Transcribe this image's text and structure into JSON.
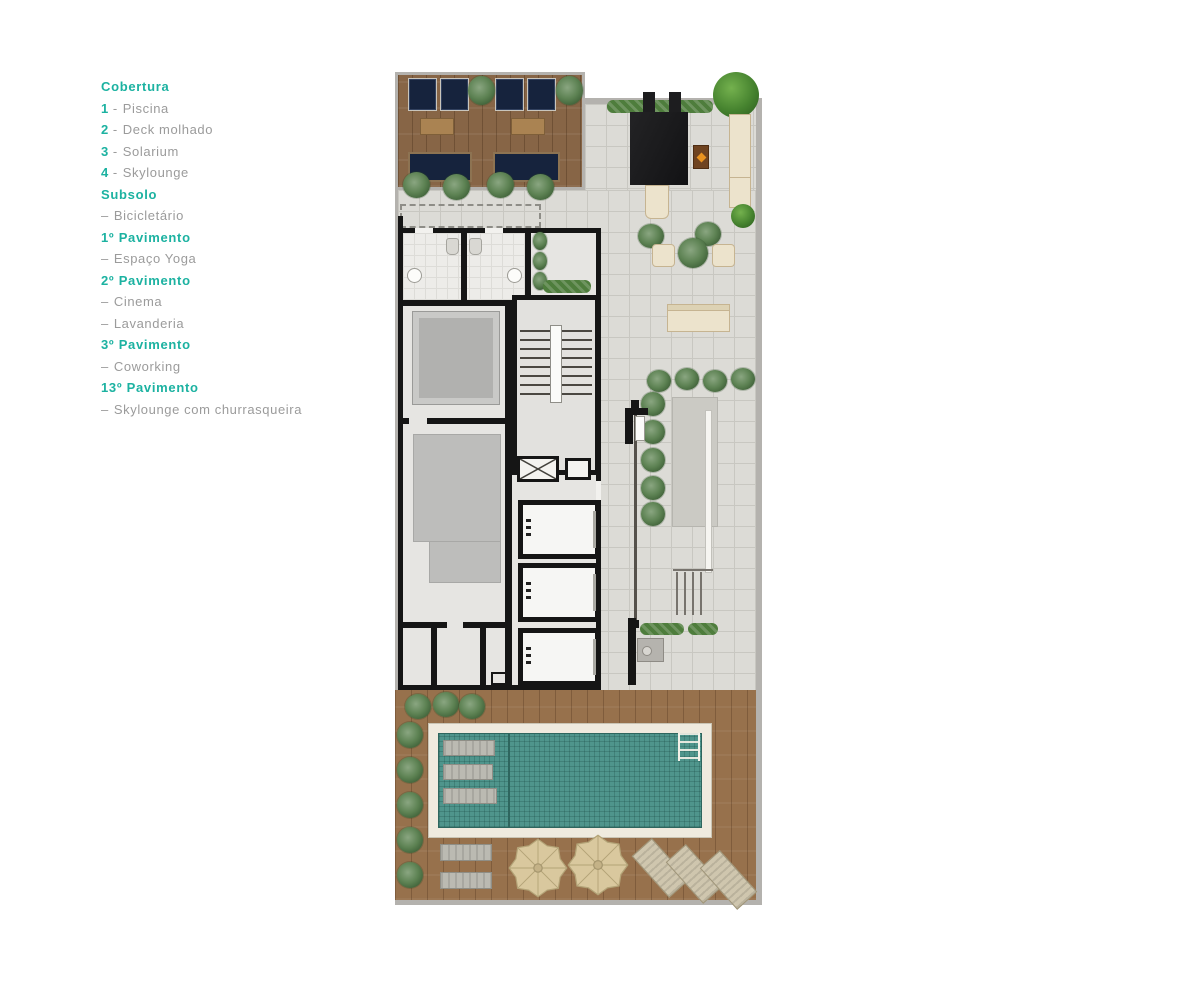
{
  "palette": {
    "accent_teal": "#1cb2a1",
    "legend_text_gray": "#9b9b9b",
    "wall_black": "#151515",
    "frame_gray": "#b4b2ae",
    "tile_gray": "#dcdbd6",
    "wood_brown": "#97714c",
    "navy_furniture": "#16233d",
    "cream_furniture": "#ece3cc",
    "pool_water_teal": "#4f958c",
    "plant_green": "#5d8253"
  },
  "legend": {
    "entries": [
      {
        "kind": "header",
        "prefix": "",
        "sep": "",
        "label": "Cobertura"
      },
      {
        "kind": "item",
        "prefix": "1",
        "sep": "-",
        "label": "Piscina"
      },
      {
        "kind": "item",
        "prefix": "2",
        "sep": "-",
        "label": "Deck molhado"
      },
      {
        "kind": "item",
        "prefix": "3",
        "sep": "-",
        "label": "Solarium"
      },
      {
        "kind": "item",
        "prefix": "4",
        "sep": "-",
        "label": "Skylounge"
      },
      {
        "kind": "header",
        "prefix": "",
        "sep": "",
        "label": "Subsolo"
      },
      {
        "kind": "item",
        "prefix": "",
        "sep": "–",
        "label": "Bicicletário"
      },
      {
        "kind": "header",
        "prefix": "",
        "sep": "",
        "label": "1º Pavimento"
      },
      {
        "kind": "item",
        "prefix": "",
        "sep": "–",
        "label": "Espaço Yoga"
      },
      {
        "kind": "header",
        "prefix": "",
        "sep": "",
        "label": "2º Pavimento"
      },
      {
        "kind": "item",
        "prefix": "",
        "sep": "–",
        "label": "Cinema"
      },
      {
        "kind": "item",
        "prefix": "",
        "sep": "–",
        "label": "Lavanderia"
      },
      {
        "kind": "header",
        "prefix": "",
        "sep": "",
        "label": "3º Pavimento"
      },
      {
        "kind": "item",
        "prefix": "",
        "sep": "–",
        "label": "Coworking"
      },
      {
        "kind": "header",
        "prefix": "",
        "sep": "",
        "label": "13º Pavimento"
      },
      {
        "kind": "item",
        "prefix": "",
        "sep": "–",
        "label": "Skylounge com churrasqueira"
      }
    ]
  },
  "plan": {
    "features": [
      "pool",
      "wet-deck-loungers",
      "skylounge-wood-deck",
      "solarium-terrace",
      "shade-canopy",
      "fire-pit",
      "chaise-lounges",
      "pouf-seats",
      "outdoor-sofa",
      "restrooms",
      "stairwell",
      "elevators",
      "machine-rooms",
      "barbecue",
      "parasols",
      "planting",
      "tiled-terrace"
    ]
  }
}
